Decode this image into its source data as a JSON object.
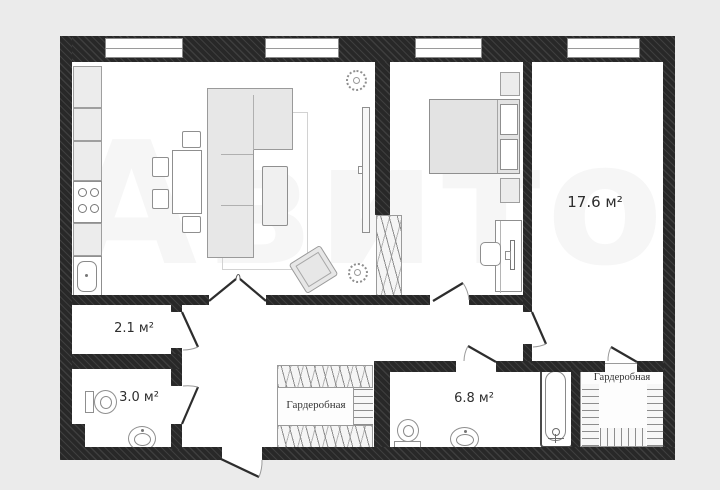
{
  "plan": {
    "watermark": "Авито",
    "rooms": {
      "room_17_6": "17.6 м²",
      "room_2_1": "2.1 м²",
      "room_3_0": "3.0 м²",
      "room_6_8": "6.8 м²",
      "wardrobe_center": "Гардеробная",
      "wardrobe_right": "Гардеробная"
    },
    "colors": {
      "background": "#ebebeb",
      "wall": "#282828",
      "room_fill": "#ffffff",
      "furniture_line": "#8f8f8f",
      "closet_hatch": "#8d8d8d",
      "label_text": "#2e2e2e"
    }
  }
}
